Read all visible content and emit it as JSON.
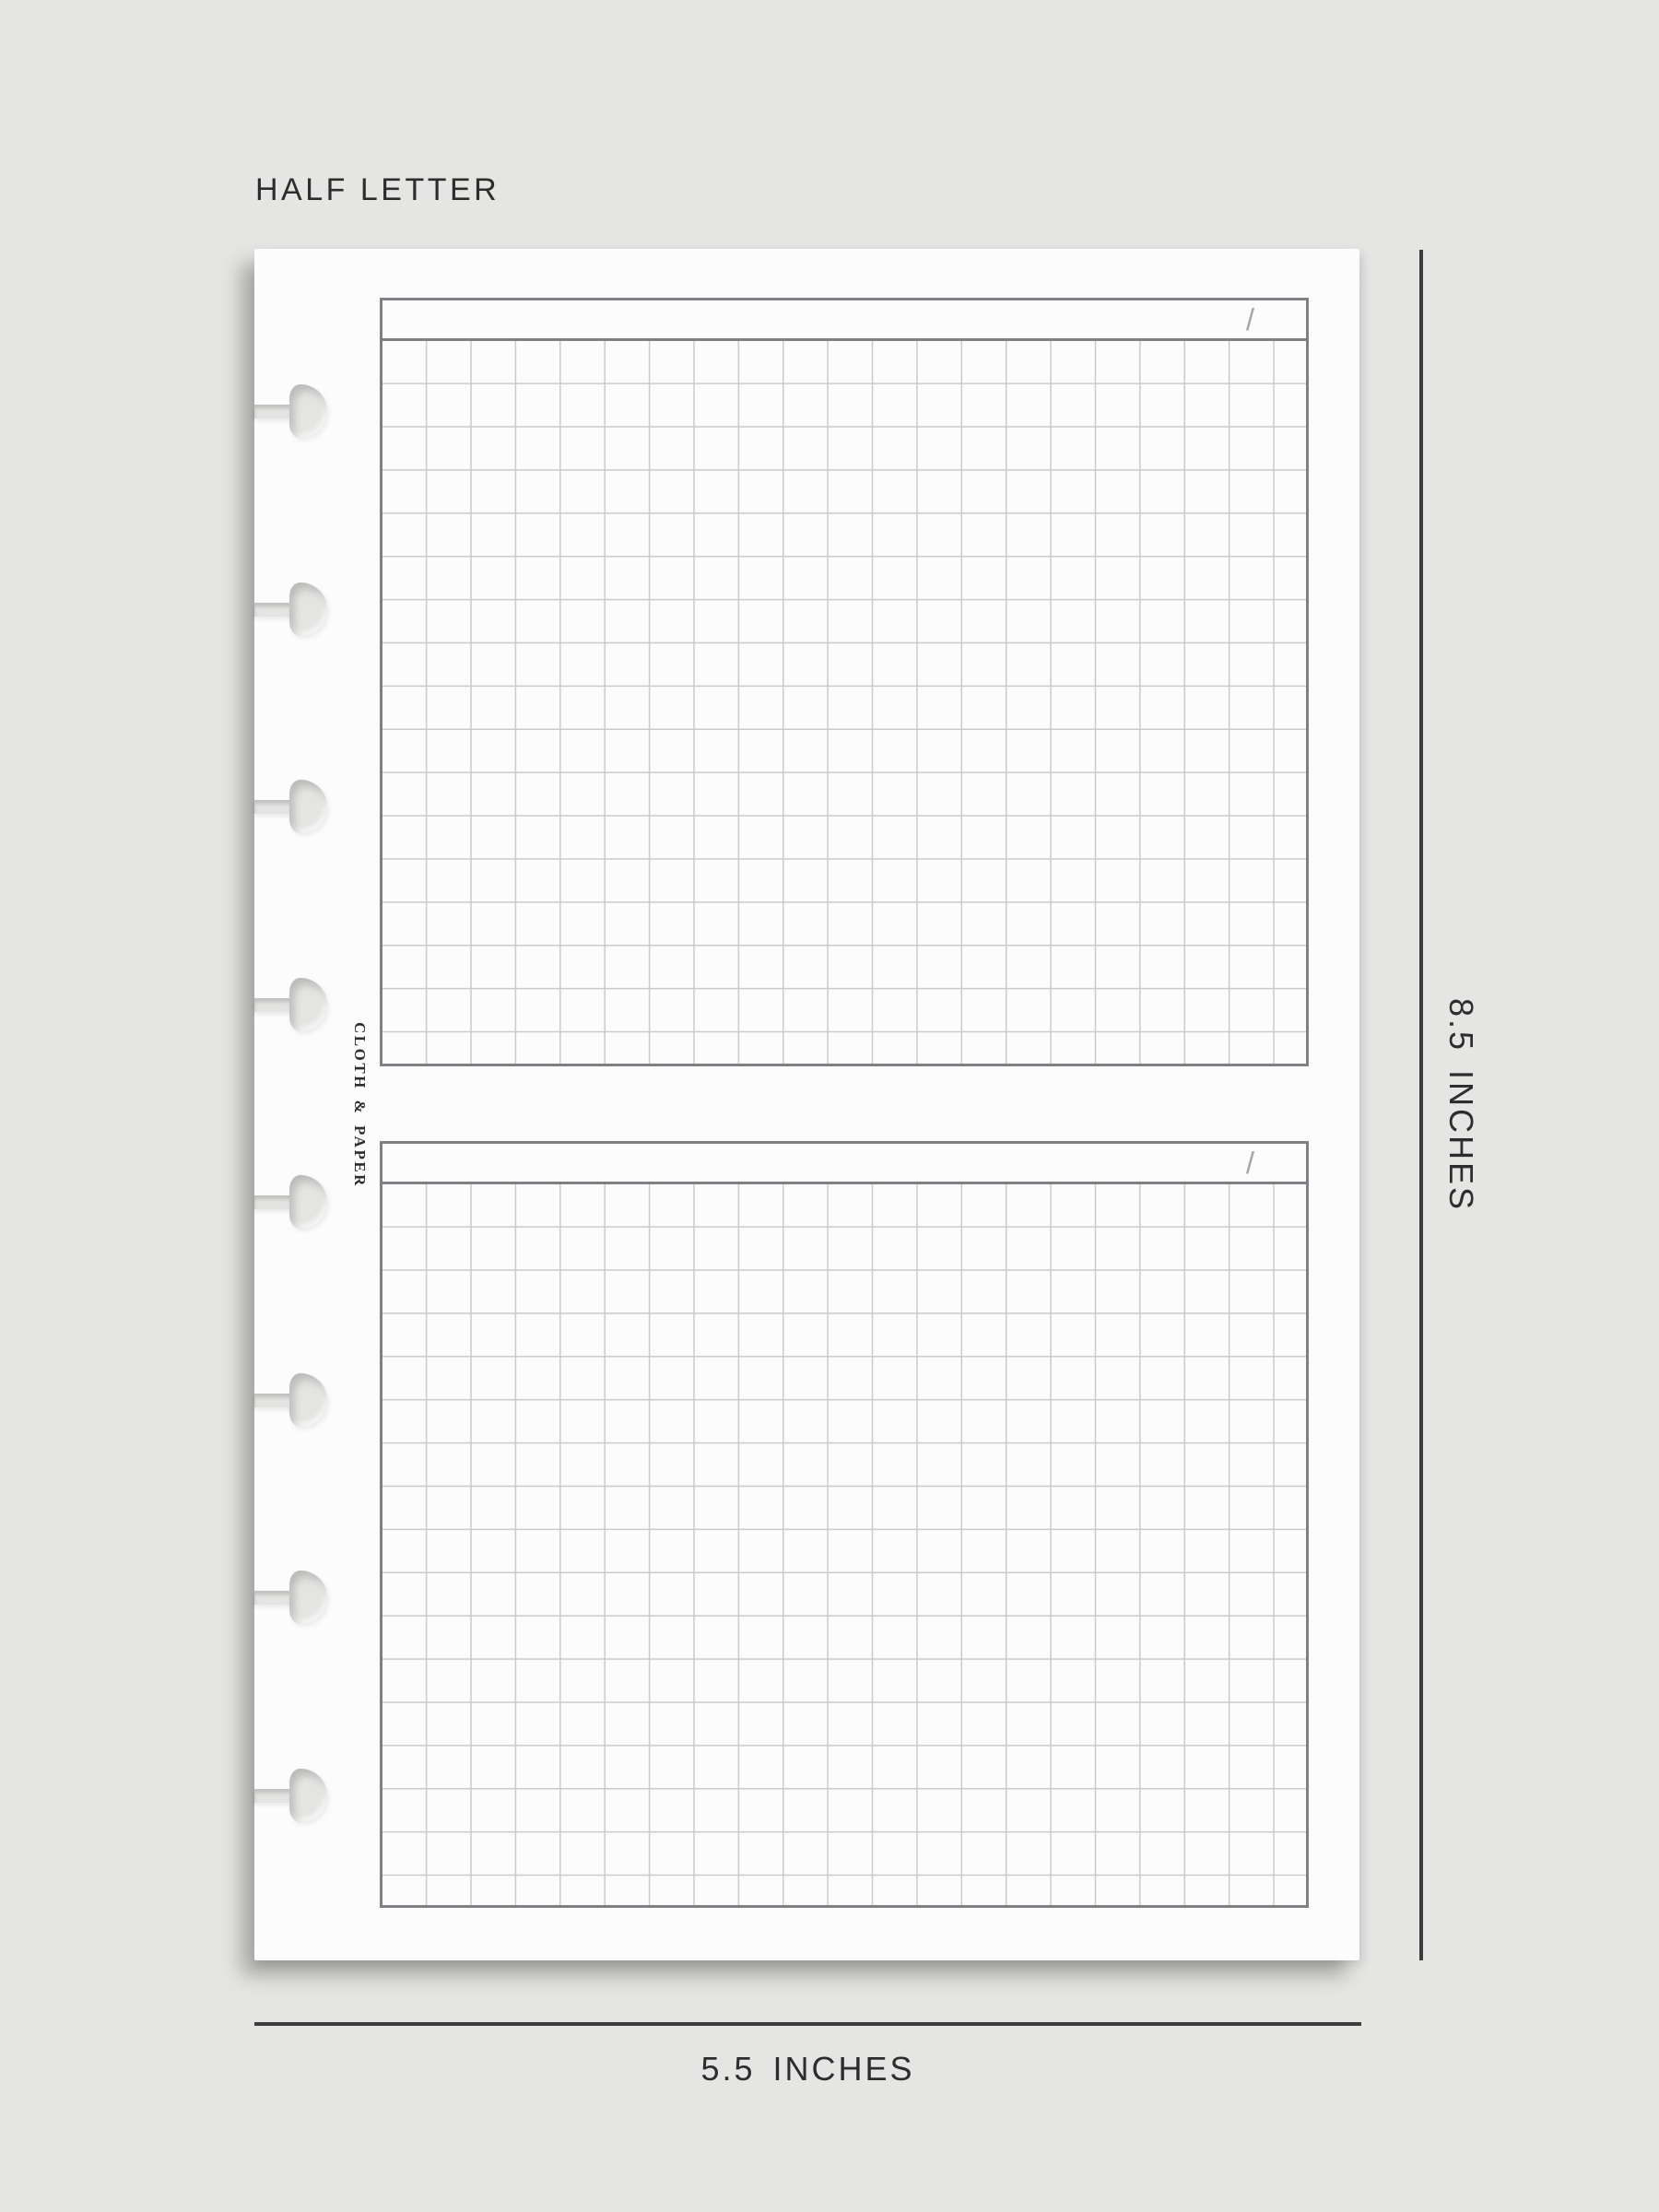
{
  "size_label": "HALF LETTER",
  "brand": {
    "name": "CLOTH & PAPER"
  },
  "sheet": {
    "punch_hole_count": 8,
    "grid_sections": [
      {
        "header_slash": "/"
      },
      {
        "header_slash": "/"
      }
    ]
  },
  "dimension_labels": {
    "height": "8.5 INCHES",
    "width": "5.5 INCHES"
  },
  "colors": {
    "background": "#e5e5e3",
    "paper": "#fcfcfc",
    "grid_line": "#c9cacd",
    "grid_border": "#7f8084",
    "dimension_line": "#3c3c3c",
    "text": "#2d2d2d",
    "slash": "#a7a7ab",
    "hole": "#e4e4e3"
  }
}
